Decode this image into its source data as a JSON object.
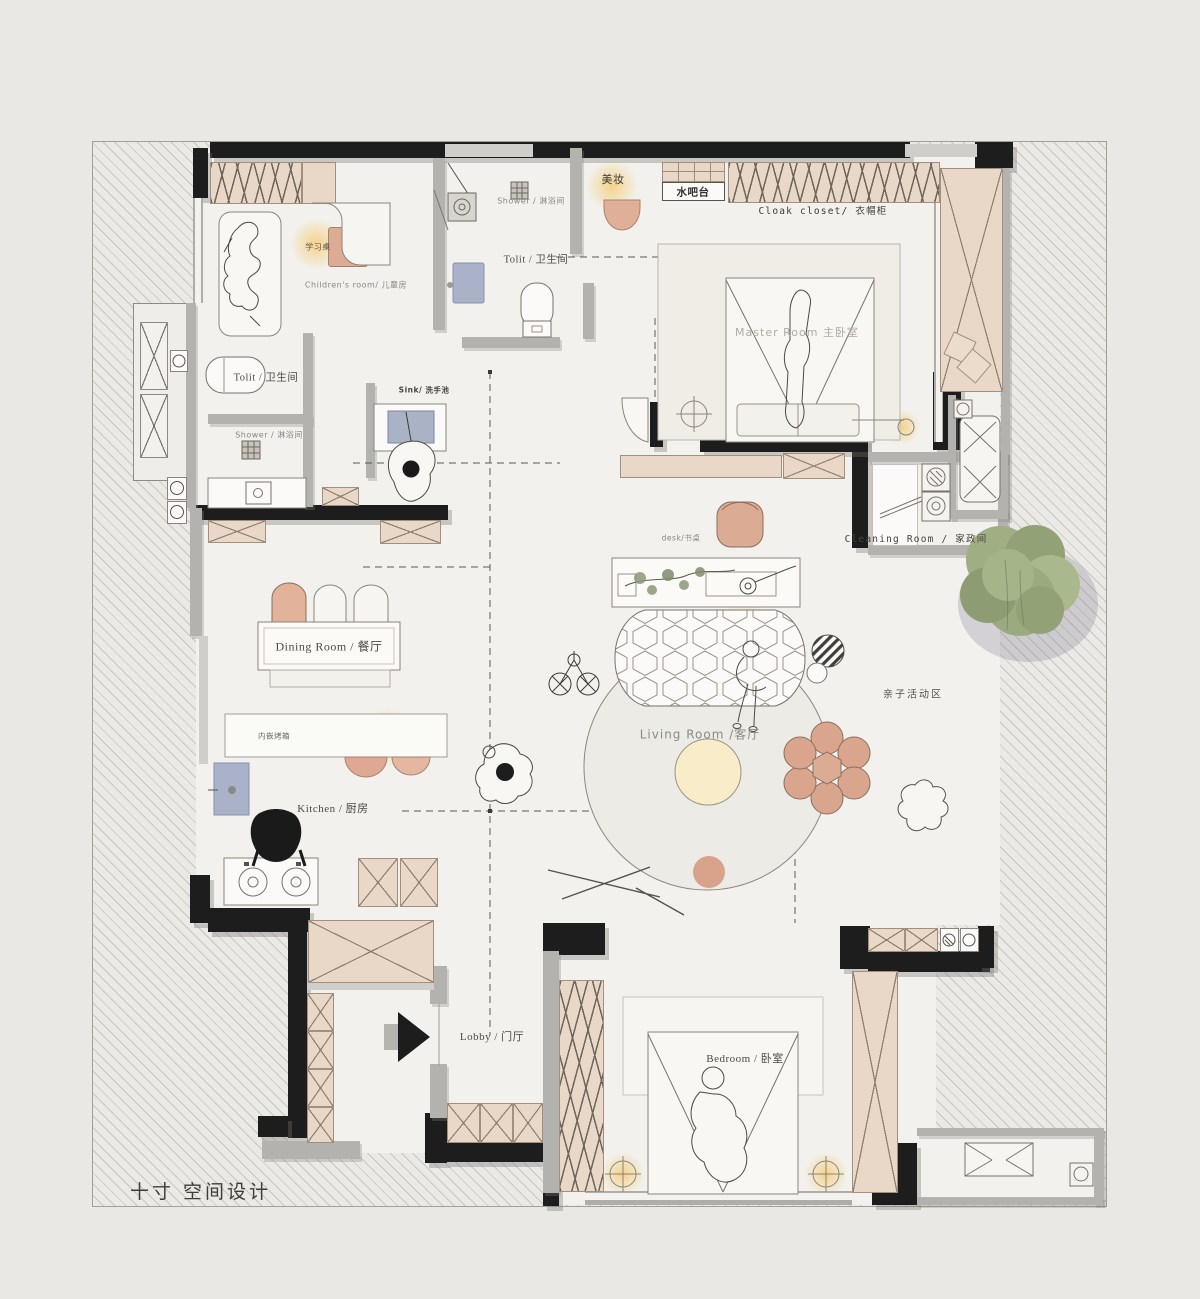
{
  "labels": {
    "makeup": "美妆",
    "water_bar": "水吧台",
    "cloak_closet": "Cloak closet/ 衣帽柜",
    "shower": "Shower / 淋浴间",
    "toilet": "Tolit / 卫生间",
    "study_desk": "学习桌",
    "children_room": "Children's room/ 儿童房",
    "master_room": "Master Room 主卧室",
    "sink": "Sink/ 洗手池",
    "desk": "desk/书桌",
    "cleaning_room": "Cleaning Room / 家政间",
    "dining_room": "Dining Room / 餐厅",
    "built_in_oven": "内嵌烤箱",
    "living_room": "Living Room /客厅",
    "kids_zone": "亲子活动区",
    "kitchen": "Kitchen / 厨房",
    "lobby": "Lobby / 门厅",
    "bedroom": "Bedroom / 卧室",
    "brand": "十寸 空间设计"
  },
  "colors": {
    "wall_black": "#1d1d1d",
    "wood_tan": "#e9d7c7",
    "accent_pink": "#dcab93",
    "lamp_glow": "#f4cb70",
    "tree_green": "#9dac80",
    "mat_blue": "#a9b2c8",
    "floor": "#f2f1ed",
    "background": "#e9e7e3"
  }
}
